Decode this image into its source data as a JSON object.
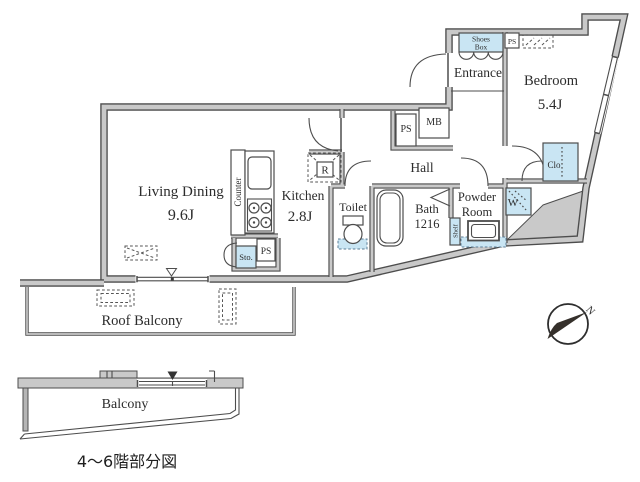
{
  "plan": {
    "rooms": {
      "living_dining": {
        "name": "Living Dining",
        "size": "9.6J"
      },
      "kitchen": {
        "name": "Kitchen",
        "size": "2.8J"
      },
      "bedroom": {
        "name": "Bedroom",
        "size": "5.4J"
      },
      "entrance": {
        "name": "Entrance"
      },
      "hall": {
        "name": "Hall"
      },
      "toilet": {
        "name": "Toilet"
      },
      "bath": {
        "name": "Bath",
        "size": "1216"
      },
      "powder_room": {
        "line1": "Powder",
        "line2": "Room"
      }
    },
    "labels": {
      "counter": "Counter",
      "shoes_box_line1": "Shoes",
      "shoes_box_line2": "Box",
      "ps": "PS",
      "mb": "MB",
      "refrigerator": "R",
      "storage": "Sto.",
      "shelf": "Shelf",
      "washer": "W",
      "closet": "Clo"
    },
    "outdoor": {
      "roof_balcony": "Roof Balcony",
      "balcony": "Balcony"
    },
    "caption": "4〜6階部分図",
    "compass": {
      "north": "N"
    },
    "colors": {
      "wall_fill": "#c9c9c9",
      "line": "#4d4d4d",
      "fixture_blue": "#c9e5f3"
    }
  }
}
